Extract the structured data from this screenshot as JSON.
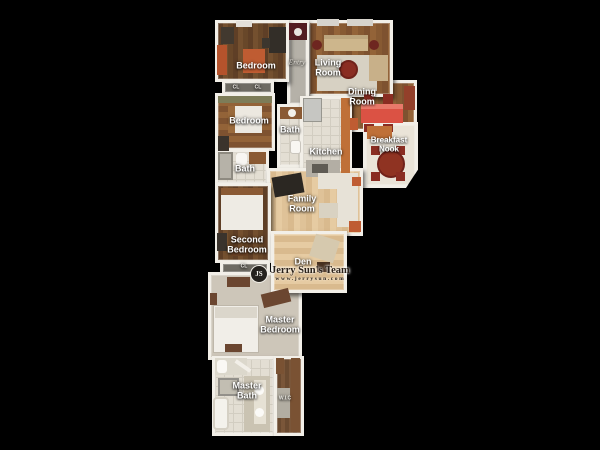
{
  "scene": {
    "background": "#000000"
  },
  "palette": {
    "wall": "#f2efe8",
    "label_text": "#ffffff",
    "dark_wood_floor": "#684729",
    "mid_wood_floor": "#875a33",
    "light_wood_floor": "#dfc298",
    "tile_floor": "#e3ded3",
    "carpet_floor": "#cdc6b9",
    "orange_furniture": "#bf5c32",
    "red_table": "#db5244",
    "dark_red_furniture": "#8a2d22",
    "watermark_text": "#2c221a"
  },
  "rooms": {
    "bedroom1": {
      "label": "Bedroom"
    },
    "entry": {
      "label": "Entry"
    },
    "living": {
      "label": "Living\nRoom"
    },
    "dining": {
      "label": "Dining\nRoom"
    },
    "bedroom2": {
      "label": "Bedroom"
    },
    "bath1": {
      "label": "Bath"
    },
    "kitchen": {
      "label": "Kitchen"
    },
    "nook": {
      "label": "Breakfast\nNook"
    },
    "bath2": {
      "label": "Bath"
    },
    "family": {
      "label": "Family\nRoom"
    },
    "second_bedroom": {
      "label": "Second\nBedroom"
    },
    "den": {
      "label": "Den"
    },
    "master_bedroom": {
      "label": "Master\nBedroom"
    },
    "master_bath": {
      "label": "Master\nBath"
    },
    "wic": {
      "label": "W.I.C"
    }
  },
  "closets": [
    {
      "label": "CL"
    },
    {
      "label": "CL"
    },
    {
      "label": "CL"
    }
  ],
  "watermark": {
    "initials": "JS",
    "team": "Jerry Sun's Team",
    "website": "www.jerrysun.com"
  }
}
